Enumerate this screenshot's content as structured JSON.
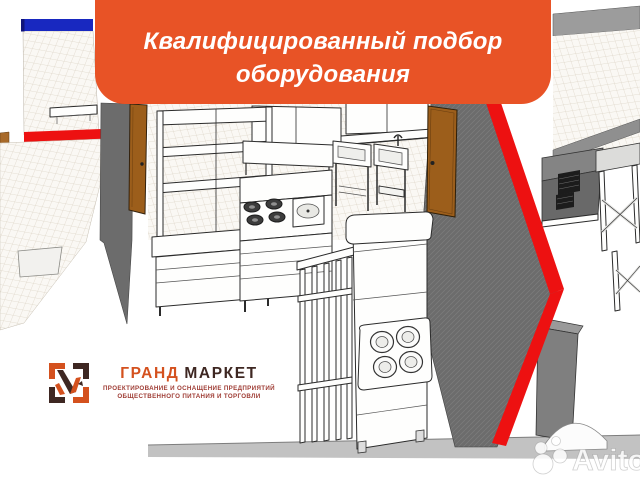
{
  "banner": {
    "line1": "Квалифицированный подбор",
    "line2": "оборудования"
  },
  "logo": {
    "brand_first": "ГРАНД",
    "brand_second": "МАРКЕТ",
    "tagline_line1": "ПРОЕКТИРОВАНИЕ И ОСНАЩЕНИЕ ПРЕДПРИЯТИЙ",
    "tagline_line2": "ОБЩЕСТВЕННОГО ПИТАНИЯ И ТОРГОВЛИ"
  },
  "watermark": {
    "label": "Avito"
  },
  "colors": {
    "banner_orange": "#E85326",
    "brand_orange": "#D4511E",
    "brand_dark": "#3E2722",
    "tagline_red": "#9E3B33",
    "accent_red": "#ED1111",
    "stripe_blue": "#1828C0",
    "wall_gray": "#6C6C6C",
    "door_brown": "#9C5E1B",
    "baseboard_gray": "#C2C2C2"
  }
}
